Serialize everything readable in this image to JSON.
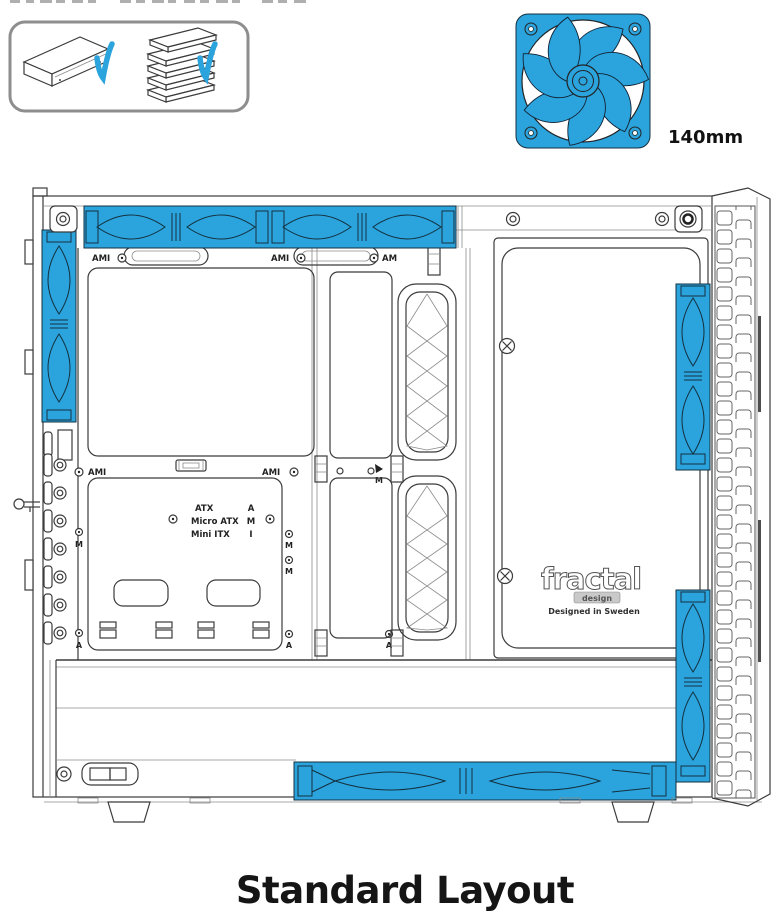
{
  "colors": {
    "accent_blue": "#2BA3DC",
    "line_dark": "#3B3B3B"
  },
  "icons": {
    "check-icon": "✓",
    "optical-drive-icon": "isometric 5.25in drive",
    "hdd-cage-icon": "stack of drive trays",
    "fan-140mm-icon": "blue 7-blade case fan"
  },
  "compatibility_box": {
    "items": [
      {
        "icon": "optical-drive-icon",
        "status": "supported",
        "status_icon": "check-icon"
      },
      {
        "icon": "hdd-cage-icon",
        "status": "supported",
        "status_icon": "check-icon"
      }
    ]
  },
  "fan_callout": {
    "size_label": "140mm"
  },
  "diagram": {
    "motherboard": {
      "types": [
        "ATX",
        "Micro ATX",
        "Mini ITX"
      ],
      "type_keys": [
        "A",
        "M",
        "I"
      ]
    },
    "standoff_markers": {
      "top_left": "AMI",
      "top_center": "AMI",
      "top_right": "AM",
      "mid_left": "AMI",
      "mid_right": "AMI",
      "mid_arrow_key": "M",
      "left_m": "M",
      "left_a": "A",
      "right_m1": "M",
      "right_m2": "M",
      "right_a": "A",
      "right_far_a": "A"
    },
    "brand": {
      "logo_main": "fractal",
      "logo_sub": "design",
      "tagline": "Designed in Sweden"
    }
  },
  "caption": {
    "title": "Standard Layout"
  }
}
